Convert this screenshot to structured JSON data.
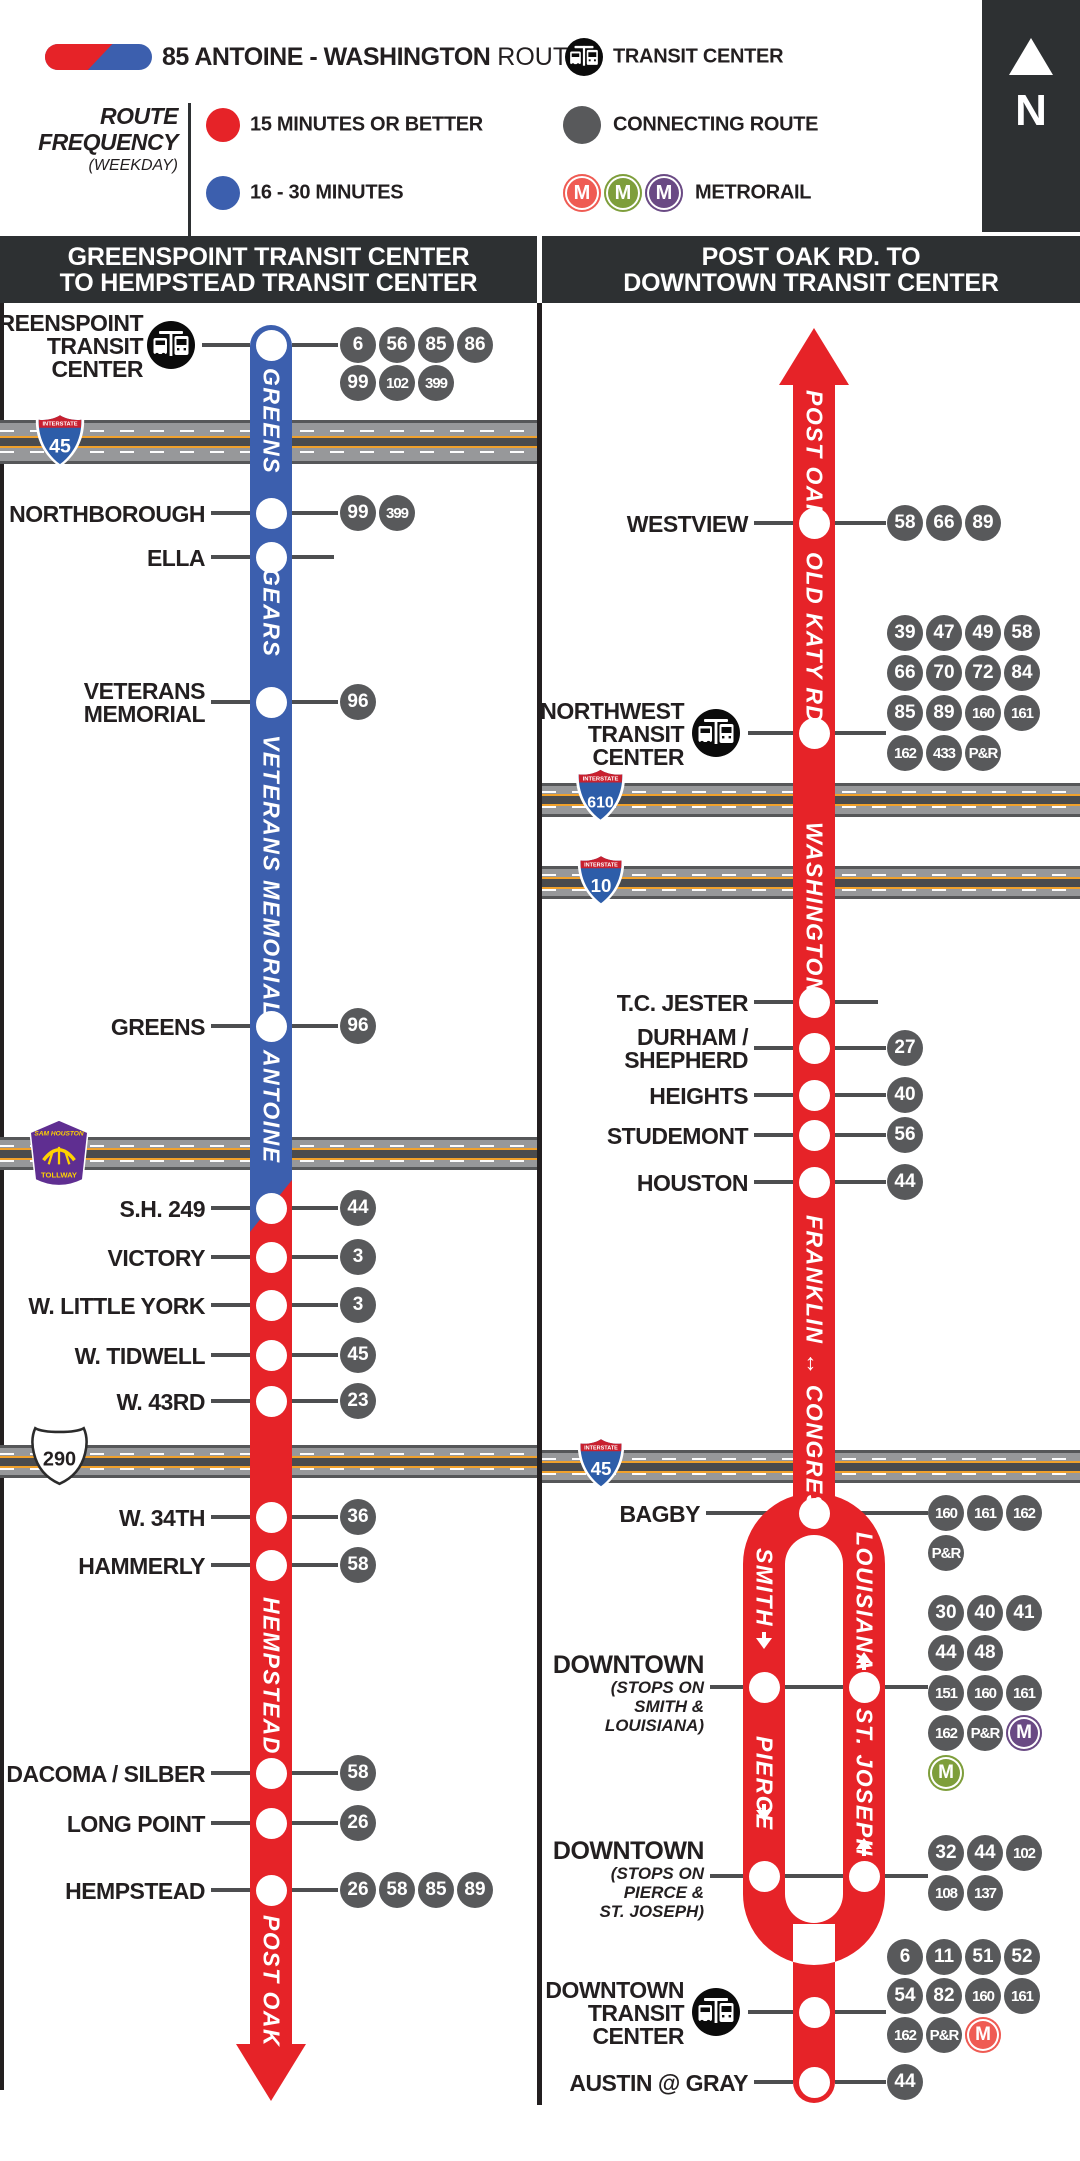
{
  "legend": {
    "route_name": "85 ANTOINE - WASHINGTON",
    "route_suffix": " ROUTE",
    "freq_line1": "ROUTE",
    "freq_line2": "FREQUENCY",
    "freq_sub": "(WEEKDAY)",
    "freq_items": [
      {
        "color": "#e62328",
        "label": "15 MINUTES OR BETTER"
      },
      {
        "color": "#3c5fae",
        "label": "16 - 30 MINUTES"
      }
    ],
    "transit_center": "TRANSIT CENTER",
    "connecting_route": "CONNECTING ROUTE",
    "metrorail": "METRORAIL",
    "metrorail_colors": [
      "#ef5b53",
      "#7e9e3b",
      "#6a4a84"
    ],
    "north": "N",
    "colors": {
      "red": "#e62328",
      "blue": "#3c5fae",
      "badge": "#58595b",
      "header": "#2d3032",
      "connector": "#4d4e50"
    }
  },
  "map": {
    "columns": [
      {
        "title": [
          "GREENSPOINT TRANSIT CENTER",
          "TO HEMPSTEAD TRANSIT CENTER"
        ],
        "x": 0,
        "w": 537,
        "line_x": 250,
        "line_w": 42,
        "defaults": {
          "label_right": 205,
          "con_left": [
            211,
            250
          ],
          "con_right": [
            292,
            338
          ],
          "badge_x0": 358
        },
        "segments": [
          {
            "type": "red",
            "y1": 1180,
            "y2": 2044
          },
          {
            "type": "blue-top",
            "y1": 325,
            "y2": 1232,
            "diag": 52
          }
        ],
        "bottom_arrow": {
          "cx": 271,
          "base_y": 2044,
          "h": 57,
          "half_w": 35
        },
        "highways": [
          {
            "kind": "interstate",
            "num": "45",
            "band_y": 420,
            "band_h": 44,
            "sx": 34,
            "sy": 410,
            "sw": 52,
            "sh": 60
          },
          {
            "kind": "tollway",
            "num": "SAM HOUSTON",
            "band_y": 1137,
            "band_h": 33,
            "sx": 28,
            "sy": 1119,
            "sw": 62,
            "sh": 68
          },
          {
            "kind": "us",
            "num": "290",
            "band_y": 1445,
            "band_h": 33,
            "sx": 31,
            "sy": 1426,
            "sw": 57,
            "sh": 60
          }
        ],
        "street_labels": [
          {
            "text": "GREENS",
            "y": 368,
            "h": 150
          },
          {
            "text": "GEARS",
            "y": 568,
            "h": 125
          },
          {
            "text": "VETERANS MEMORIAL",
            "y": 735,
            "h": 270
          },
          {
            "text": "ANTOINE",
            "y": 1050,
            "h": 125
          },
          {
            "text": "HEMPSTEAD",
            "y": 1597,
            "h": 150
          },
          {
            "text": "POST OAK",
            "y": 1915,
            "h": 122
          }
        ],
        "stops": [
          {
            "label": [
              "GREENSPOINT",
              "TRANSIT",
              "CENTER"
            ],
            "label_right": 143,
            "y": 345,
            "tc_icon": true,
            "icon_cx": 171,
            "con_left": [
              202,
              250
            ],
            "badges": [
              {
                "y": 345,
                "items": [
                  "6",
                  "56",
                  "85",
                  "86"
                ]
              },
              {
                "y": 383,
                "items": [
                  "99",
                  "102",
                  "399"
                ]
              }
            ]
          },
          {
            "label": [
              "NORTHBOROUGH"
            ],
            "y": 513,
            "badges": [
              {
                "y": 513,
                "items": [
                  "99",
                  "399"
                ]
              }
            ]
          },
          {
            "label": [
              "ELLA"
            ],
            "y": 557,
            "con_right": [
              292,
              334
            ],
            "badges": []
          },
          {
            "label": [
              "VETERANS",
              "MEMORIAL"
            ],
            "y": 702,
            "badges": [
              {
                "y": 702,
                "items": [
                  "96"
                ]
              }
            ]
          },
          {
            "label": [
              "GREENS"
            ],
            "y": 1026,
            "badges": [
              {
                "y": 1026,
                "items": [
                  "96"
                ]
              }
            ]
          },
          {
            "label": [
              "S.H. 249"
            ],
            "y": 1208,
            "badges": [
              {
                "y": 1208,
                "items": [
                  "44"
                ]
              }
            ]
          },
          {
            "label": [
              "VICTORY"
            ],
            "y": 1257,
            "badges": [
              {
                "y": 1257,
                "items": [
                  "3"
                ]
              }
            ]
          },
          {
            "label": [
              "W. LITTLE YORK"
            ],
            "y": 1305,
            "badges": [
              {
                "y": 1305,
                "items": [
                  "3"
                ]
              }
            ]
          },
          {
            "label": [
              "W. TIDWELL"
            ],
            "y": 1355,
            "badges": [
              {
                "y": 1355,
                "items": [
                  "45"
                ]
              }
            ]
          },
          {
            "label": [
              "W. 43RD"
            ],
            "y": 1401,
            "badges": [
              {
                "y": 1401,
                "items": [
                  "23"
                ]
              }
            ]
          },
          {
            "label": [
              "W. 34TH"
            ],
            "y": 1517,
            "badges": [
              {
                "y": 1517,
                "items": [
                  "36"
                ]
              }
            ]
          },
          {
            "label": [
              "HAMMERLY"
            ],
            "y": 1565,
            "badges": [
              {
                "y": 1565,
                "items": [
                  "58"
                ]
              }
            ]
          },
          {
            "label": [
              "DACOMA / SILBER"
            ],
            "y": 1773,
            "badges": [
              {
                "y": 1773,
                "items": [
                  "58"
                ]
              }
            ]
          },
          {
            "label": [
              "LONG POINT"
            ],
            "y": 1823,
            "badges": [
              {
                "y": 1823,
                "items": [
                  "26"
                ]
              }
            ]
          },
          {
            "label": [
              "HEMPSTEAD"
            ],
            "y": 1890,
            "badges": [
              {
                "y": 1890,
                "items": [
                  "26",
                  "58",
                  "85",
                  "89"
                ]
              }
            ]
          }
        ]
      },
      {
        "title": [
          "POST OAK RD. TO",
          "DOWNTOWN TRANSIT CENTER"
        ],
        "x": 542,
        "w": 538,
        "line_x": 793,
        "line_w": 42,
        "defaults": {
          "label_right": 748,
          "con_left": [
            754,
            793
          ],
          "con_right": [
            835,
            886
          ],
          "badge_x0": 905
        },
        "segments": [
          {
            "type": "red",
            "y1": 384,
            "y2": 1528
          }
        ],
        "top_arrow": {
          "cx": 814,
          "tip_y": 328,
          "h": 57,
          "half_w": 35
        },
        "loop": {
          "outer_l": 743,
          "outer_r": 885,
          "inner_l": 785,
          "inner_r": 843,
          "top_cy": 1564,
          "bot_cy": 1894,
          "stem_l": 793,
          "stem_r": 835,
          "stem_y2": 2082,
          "cap_r": 21
        },
        "highways": [
          {
            "kind": "interstate",
            "num": "610",
            "band_y": 783,
            "band_h": 34,
            "sx": 574,
            "sy": 764,
            "sw": 53,
            "sh": 62
          },
          {
            "kind": "interstate",
            "num": "10",
            "band_y": 866,
            "band_h": 33,
            "sx": 576,
            "sy": 850,
            "sw": 50,
            "sh": 60
          },
          {
            "kind": "interstate",
            "num": "45",
            "band_y": 1450,
            "band_h": 33,
            "sx": 576,
            "sy": 1433,
            "sw": 50,
            "sh": 60
          }
        ],
        "street_labels": [
          {
            "text": "POST OAK",
            "y": 390,
            "h": 115
          },
          {
            "text": "OLD KATY RD.",
            "y": 552,
            "h": 155
          },
          {
            "text": "WASHINGTON",
            "y": 822,
            "h": 170
          },
          {
            "text": "FRANKLIN ↔ CONGRESS",
            "y": 1215,
            "h": 280
          }
        ],
        "leg_labels": [
          {
            "text": "SMITH",
            "x": 743,
            "y": 1548,
            "h": 85,
            "arrow": "down",
            "arrow_y": 1638
          },
          {
            "text": "LOUISIANA",
            "x": 843,
            "y": 1532,
            "h": 110,
            "arrow": "up",
            "arrow_y": 1652
          },
          {
            "text": "PIERCE",
            "x": 743,
            "y": 1736,
            "h": 68,
            "arrow": "down",
            "arrow_y": 1810
          },
          {
            "text": "ST. JOSEPH",
            "x": 843,
            "y": 1708,
            "h": 122,
            "arrow": "up",
            "arrow_y": 1838
          }
        ],
        "stops": [
          {
            "label": [
              "WESTVIEW"
            ],
            "y": 523,
            "badges": [
              {
                "y": 523,
                "items": [
                  "58",
                  "66",
                  "89"
                ]
              }
            ]
          },
          {
            "label": [
              "NORTHWEST",
              "TRANSIT",
              "CENTER"
            ],
            "label_right": 684,
            "y": 733,
            "tc_icon": true,
            "icon_cx": 716,
            "con_left": [
              748,
              793
            ],
            "badges": [
              {
                "y": 633,
                "items": [
                  "39",
                  "47",
                  "49",
                  "58"
                ]
              },
              {
                "y": 673,
                "items": [
                  "66",
                  "70",
                  "72",
                  "84"
                ]
              },
              {
                "y": 713,
                "items": [
                  "85",
                  "89",
                  "160",
                  "161"
                ]
              },
              {
                "y": 753,
                "items": [
                  "162",
                  "433",
                  "P&R"
                ]
              }
            ]
          },
          {
            "label": [
              "T.C. JESTER"
            ],
            "y": 1002,
            "con_right": [
              835,
              878
            ],
            "badges": []
          },
          {
            "label": [
              "DURHAM /",
              "SHEPHERD"
            ],
            "y": 1048,
            "badges": [
              {
                "y": 1048,
                "items": [
                  "27"
                ]
              }
            ]
          },
          {
            "label": [
              "HEIGHTS"
            ],
            "y": 1095,
            "badges": [
              {
                "y": 1095,
                "items": [
                  "40"
                ]
              }
            ]
          },
          {
            "label": [
              "STUDEMONT"
            ],
            "y": 1135,
            "badges": [
              {
                "y": 1135,
                "items": [
                  "56"
                ]
              }
            ]
          },
          {
            "label": [
              "HOUSTON"
            ],
            "y": 1182,
            "badges": [
              {
                "y": 1182,
                "items": [
                  "44"
                ]
              }
            ]
          },
          {
            "label": [
              "BAGBY"
            ],
            "label_right": 700,
            "y": 1513,
            "con_left": [
              706,
              928
            ],
            "no_right": true,
            "badges": [
              {
                "y": 1513,
                "x0": 946,
                "items": [
                  "160",
                  "161",
                  "162"
                ]
              },
              {
                "y": 1553,
                "x0": 946,
                "items": [
                  "P&R"
                ]
              }
            ]
          },
          {
            "label": [
              "DOWNTOWN"
            ],
            "sub": [
              "(STOPS ON",
              "SMITH &",
              "LOUISIANA)"
            ],
            "label_right": 704,
            "label_top": 1652,
            "y": 1687,
            "con_left": [
              710,
              928
            ],
            "no_right": true,
            "circles": [
              764,
              864
            ],
            "badges": [
              {
                "y": 1613,
                "x0": 946,
                "items": [
                  "30",
                  "40",
                  "41"
                ]
              },
              {
                "y": 1653,
                "x0": 946,
                "items": [
                  "44",
                  "48"
                ]
              },
              {
                "y": 1693,
                "x0": 946,
                "items": [
                  "151",
                  "160",
                  "161"
                ]
              },
              {
                "y": 1733,
                "x0": 946,
                "items": [
                  "162",
                  "P&R",
                  "M_PURPLE"
                ]
              },
              {
                "y": 1773,
                "x0": 946,
                "items": [
                  "M_GREEN"
                ]
              }
            ]
          },
          {
            "label": [
              "DOWNTOWN"
            ],
            "sub": [
              "(STOPS ON",
              "PIERCE &",
              "ST. JOSEPH)"
            ],
            "label_right": 704,
            "label_top": 1838,
            "y": 1876,
            "con_left": [
              710,
              928
            ],
            "no_right": true,
            "circles": [
              764,
              864
            ],
            "badges": [
              {
                "y": 1853,
                "x0": 946,
                "items": [
                  "32",
                  "44",
                  "102"
                ]
              },
              {
                "y": 1893,
                "x0": 946,
                "items": [
                  "108",
                  "137"
                ]
              }
            ]
          },
          {
            "label": [
              "DOWNTOWN",
              "TRANSIT",
              "CENTER"
            ],
            "label_right": 684,
            "y": 2012,
            "tc_icon": true,
            "icon_cx": 716,
            "con_left": [
              748,
              793
            ],
            "badges": [
              {
                "y": 1957,
                "items": [
                  "6",
                  "11",
                  "51",
                  "52"
                ]
              },
              {
                "y": 1996,
                "items": [
                  "54",
                  "82",
                  "160",
                  "161"
                ]
              },
              {
                "y": 2035,
                "items": [
                  "162",
                  "P&R",
                  "M_RED"
                ]
              }
            ]
          },
          {
            "label": [
              "AUSTIN @ GRAY"
            ],
            "y": 2082,
            "badges": [
              {
                "y": 2082,
                "items": [
                  "44"
                ]
              }
            ]
          }
        ]
      }
    ]
  }
}
